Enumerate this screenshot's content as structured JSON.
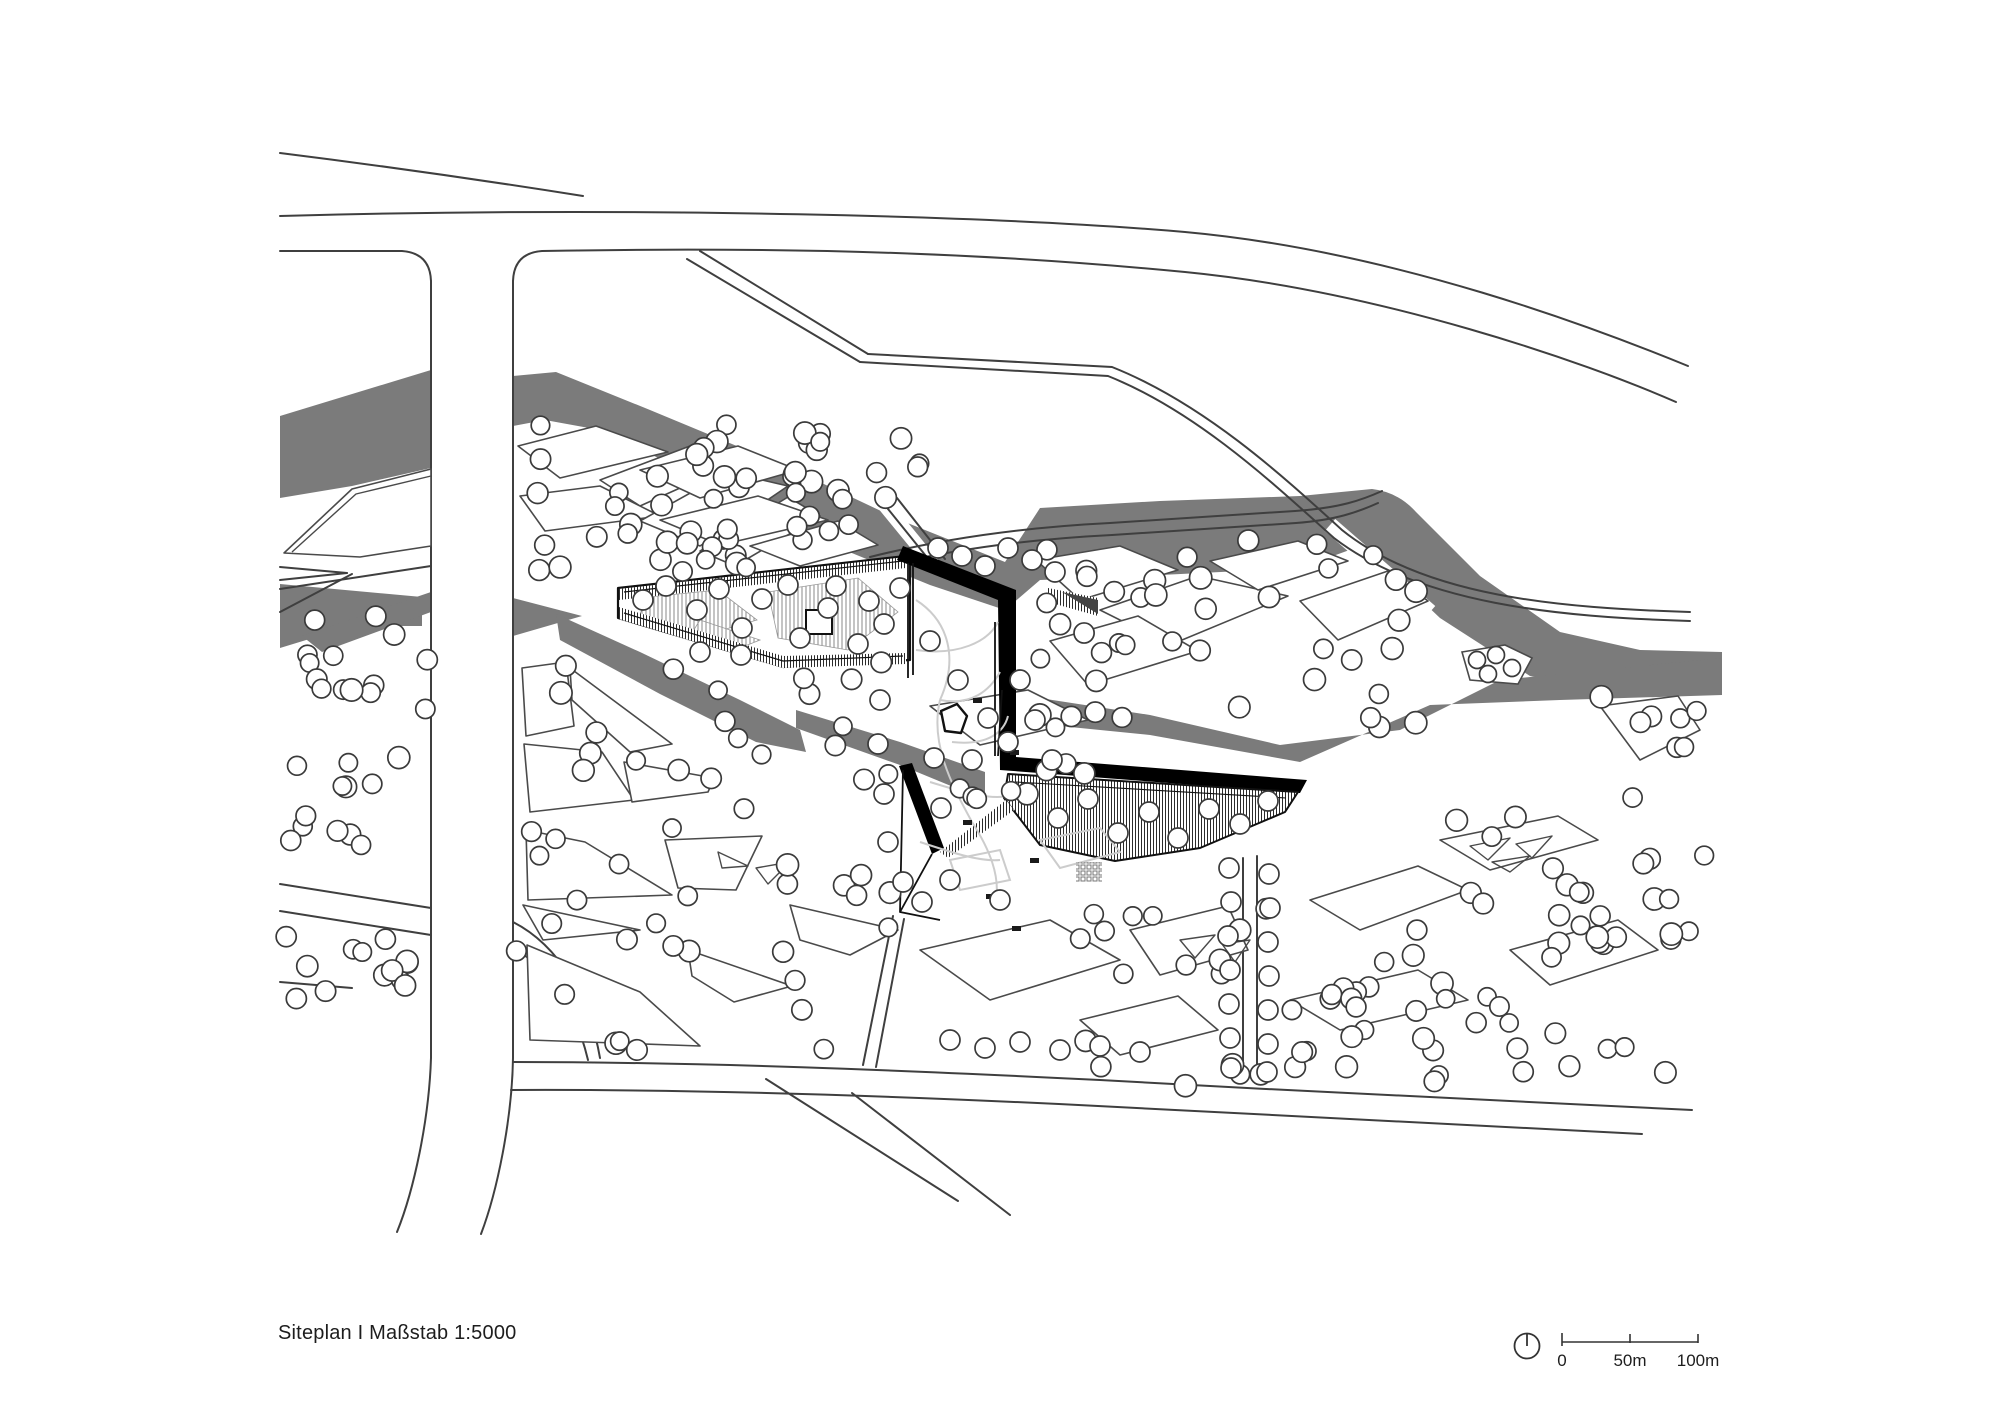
{
  "caption": {
    "text": "Siteplan I Maßstab 1:5000"
  },
  "scale_bar": {
    "labels": [
      "0",
      "50m",
      "100m"
    ],
    "north_indicator": "clock-style north circle"
  },
  "colors": {
    "river": "#7b7b7b",
    "road_line": "#3f3f3f",
    "parcel_line": "#4a4a4a",
    "building_black": "#000000",
    "tree_stroke": "#3a3a3a",
    "courtyard_path": "#cccccc",
    "background": "#ffffff",
    "text": "#1d1d1d"
  },
  "plan": {
    "rivers": [
      "M 280,416 L 431,370 L 431,468 L 352,486 L 280,498 Z",
      "M 513,376 L 556,372 L 650,410 L 790,468 L 900,520 L 1005,562 L 1005,610 L 930,585 L 820,540 L 700,478 L 600,430 L 545,420 L 513,426 Z",
      "M 1005,562 L 1040,508 L 1160,501 L 1300,496 L 1372,489 Q 1398,492 1416,512 L 1480,576 L 1560,632 L 1640,650 L 1722,652 L 1722,694 L 1620,692 L 1530,676 L 1440,618 L 1385,566 L 1355,548 L 1300,568 L 1120,577 L 1040,580 L 1005,610 Z",
      "M 280,584 L 422,597 L 422,626 L 352,626 L 280,648 Z",
      "M 302,636 L 431,592 L 431,612 L 322,652 Z",
      "M 513,598 L 582,616 L 513,636 Z",
      "M 556,614 L 640,652 L 740,700 L 800,730 L 806,752 L 756,742 L 660,694 L 560,640 Z",
      "M 796,710 L 900,742 L 985,772 L 985,800 L 900,765 L 796,728 Z",
      "M 1020,695 L 1150,715 L 1280,745 L 1400,730 L 1500,680 L 1722,658 L 1722,695 L 1560,700 L 1430,705 L 1300,762 L 1150,735 L 1020,722 Z"
    ],
    "river_gaps": [
      {
        "d": "M 882,502 L 936,568",
        "w": 14
      },
      {
        "d": "M 1330,525 L 1430,612",
        "w": 16
      }
    ],
    "roads": [
      "M 280,153 C 400,168 520,186 583,196",
      "M 280,216 C 640,206 1000,216 1185,232 C 1395,251 1600,330 1688,366",
      "M 280,251 L 402,251 Q 430,253 431,281",
      "M 513,281 Q 514,253 542,251 C 820,246 1010,255 1185,272 C 1380,291 1585,362 1676,402",
      "M 431,281 L 431,1058 C 429,1120 414,1190 397,1232",
      "M 513,281 L 513,1058 C 512,1120 497,1192 481,1234",
      "M 700,251 L 868,354",
      "M 687,259 L 860,362",
      "M 868,354 L 1112,367 C 1205,404 1285,478 1342,530 C 1425,597 1560,608 1690,612",
      "M 860,362 L 1108,376 C 1198,412 1276,486 1334,538 C 1420,604 1558,617 1690,621",
      "M 870,557 C 950,537 1030,527 1110,523 L 1295,511 C 1340,508 1362,500 1382,491",
      "M 876,568 C 952,549 1032,539 1112,535 L 1296,523 C 1336,520 1358,512 1378,503",
      "M 884,504 L 934,566",
      "M 897,498 L 945,559",
      "M 513,1062 C 700,1062 900,1070 1100,1080 C 1300,1091 1510,1102 1692,1110",
      "M 511,1090 C 700,1089 900,1096 1098,1106 C 1300,1117 1500,1127 1642,1134",
      "M 766,1079 L 958,1201",
      "M 852,1093 L 1010,1215",
      "M 893,916 L 863,1065",
      "M 904,919 L 876,1067",
      "M 1243,858 L 1243,1082",
      "M 1257,856 L 1257,1084",
      "M 280,884 L 431,908",
      "M 280,911 L 431,935",
      "M 513,922 C 560,946 590,1000 600,1058",
      "M 513,948 C 552,970 576,1010 588,1060",
      "M 280,567 L 347,573",
      "M 280,580 L 347,573",
      "M 280,589 L 431,566",
      "M 280,612 L 352,574",
      "M 280,982 L 352,988"
    ],
    "parcels": [
      "M 284,553 L 352,489 431,469 431,546 360,557 Z",
      "M 518,446 L 596,426 668,452 560,478 Z",
      "M 600,480 L 690,446 740,461 640,506 Z",
      "M 520,496 L 600,486 660,516 545,531 Z",
      "M 640,521 L 728,472 788,486 700,546 Z",
      "M 700,551 L 788,497 820,516 735,566 Z",
      "M 640,470 L 738,446 798,470 700,498 Z",
      "M 660,520 L 758,496 828,520 720,545 Z",
      "M 750,546 L 838,521 878,545 800,566 Z",
      "M 1036,560 L 1120,546 1178,570 1080,600 Z",
      "M 1100,610 L 1198,576 1288,596 1170,645 Z",
      "M 1210,561 L 1298,541 1348,561 1258,590 Z",
      "M 1300,601 L 1388,571 1428,601 1338,640 Z",
      "M 1050,641 L 1138,616 1198,651 1088,685 Z",
      "M 522,668 L 566,662 574,726 526,736 Z",
      "M 570,668 L 672,744 630,752 572,700 Z",
      "M 524,744 L 602,752 634,800 530,812 Z",
      "M 624,762 L 714,778 708,792 632,802 Z",
      "M 526,830 L 585,842 672,895 528,900 Z",
      "M 523,905 L 640,930 543,940 Z",
      "M 527,945 L 640,992 700,1046 530,1040 Z",
      "M 665,840 L 762,836 736,890 678,888 Z",
      "M 688,950 L 792,986 734,1002 692,976 Z",
      "M 790,905 L 898,930 850,955 800,940 Z",
      "M 930,706 L 1028,690 1088,720 980,745 Z",
      "M 920,950 L 1050,920 1120,960 990,1000 Z",
      "M 1130,930 L 1228,906 1248,950 1160,975 Z",
      "M 1310,900 L 1418,866 1468,890 1360,930 Z",
      "M 1440,840 L 1558,816 1598,840 1490,870 Z",
      "M 1290,1000 L 1418,970 1468,1000 1340,1030 Z",
      "M 1510,950 L 1618,920 1658,950 1550,985 Z",
      "M 1080,1020 L 1178,996 1218,1030 1120,1055 Z",
      "M 1600,706 L 1678,696 1700,730 1640,760 Z"
    ],
    "parcel_details": [
      "M 292,552 L 356,494 431,476",
      "M 718,852 L 748,866 722,868 Z",
      "M 756,868 L 790,862 768,884 Z",
      "M 1180,940 L 1215,935 1195,958 Z",
      "M 1222,944 L 1250,940 1235,962 Z",
      "M 1470,846 L 1510,838 1488,860 Z",
      "M 1516,844 L 1552,836 1532,858 Z",
      "M 1492,862 L 1530,856 1510,872 Z"
    ],
    "island": {
      "d": "M 1462,652 L 1505,645 L 1532,658 L 1518,684 L 1470,680 Z",
      "trees": [
        [
          1477,
          660
        ],
        [
          1496,
          655
        ],
        [
          1512,
          668
        ],
        [
          1488,
          674
        ]
      ]
    },
    "building": {
      "wing_upper": {
        "outline": "M 618,588 L 906,556 L 910,563 L 910,660 L 783,667 L 618,618 Z",
        "inner_lines": [
          "M 624,592 L 903,561",
          "M 624,613 L 783,661 L 903,656"
        ],
        "strips": [
          "M 619,589 L 906,557 L 906,568 L 619,600 Z",
          "M 619,607 L 783,656 L 906,653 L 906,664 L 783,668 L 619,619 Z"
        ],
        "patches": [
          "M 648,597 L 718,590 757,620 688,640 640,614 Z",
          "M 768,592 L 858,578 898,612 848,650 778,638 Z",
          "M 700,620 L 760,640 730,652 690,636 Z"
        ],
        "roof_square": {
          "x": 806,
          "y": 610,
          "w": 26,
          "h": 24
        }
      },
      "black_shapes": [
        "M 903,546 L 1016,590 L 1016,757 L 1307,780 L 1300,793 L 1000,770 L 998,600 L 897,560 Z",
        "M 899,766 L 912,763 L 944,848 L 932,854 Z"
      ],
      "wing_lower": {
        "outline": "M 1008,774 L 1298,792 L 1285,812 L 1200,848 L 1115,861 L 1040,845 L 1004,798 Z",
        "inner_lines": [
          "M 1016,782 L 1286,798"
        ],
        "strip_sw": "M 940,852 L 1006,800 L 1014,810 L 948,858 Z"
      },
      "courtyard": {
        "edges": [
          "M 908,563 L 908,678",
          "M 913,563 L 913,675",
          "M 932,854 L 900,912 L 903,770",
          "M 900,912 L 940,920",
          "M 995,622 L 995,756",
          "M 1002,690 L 998,756"
        ],
        "stair_tri": "M 1062,592 L 1098,600 L 1098,614 Z",
        "stair_ticks": "M 1048,588 L 1098,598 L 1098,616 L 1048,602 Z",
        "grid": {
          "x": 1076,
          "y": 862,
          "w": 26,
          "h": 20
        },
        "pond": "M 941,711 L 957,704 L 967,716 L 961,733 L 945,731 Z",
        "benches": [
          [
            973,
            698,
            9,
            5
          ],
          [
            1010,
            750,
            9,
            5
          ],
          [
            1020,
            788,
            9,
            5
          ],
          [
            963,
            820,
            9,
            5
          ],
          [
            986,
            894,
            9,
            5
          ],
          [
            1012,
            926,
            9,
            5
          ],
          [
            1030,
            858,
            9,
            5
          ]
        ],
        "paths_light": [
          "M 916,600 C 950,622 958,660 940,700",
          "M 940,700 C 930,742 950,782 972,822",
          "M 916,650 C 958,656 988,642 998,622",
          "M 940,700 C 972,706 990,690 1000,672",
          "M 952,742 C 988,746 1004,732 1008,716",
          "M 930,782 C 962,792 990,800 1008,796",
          "M 920,842 C 950,852 980,862 1000,860",
          "M 972,822 C 990,850 1000,876 996,900",
          "M 1040,840 L 1100,828 1120,852 1060,868 Z",
          "M 950,860 L 1000,850 1010,880 960,890 Z"
        ]
      }
    },
    "trees": {
      "radius": 10,
      "clusters": [
        {
          "x": 288,
          "y": 616,
          "w": 140,
          "h": 96,
          "n": 14,
          "seed": 1
        },
        {
          "x": 290,
          "y": 754,
          "w": 112,
          "h": 92,
          "n": 12,
          "seed": 2
        },
        {
          "x": 286,
          "y": 936,
          "w": 138,
          "h": 82,
          "n": 13,
          "seed": 3
        },
        {
          "x": 516,
          "y": 424,
          "w": 300,
          "h": 150,
          "n": 33,
          "seed": 4
        },
        {
          "x": 622,
          "y": 432,
          "w": 300,
          "h": 128,
          "n": 24,
          "seed": 5
        },
        {
          "x": 1038,
          "y": 540,
          "w": 400,
          "h": 190,
          "n": 40,
          "seed": 6
        },
        {
          "x": 1600,
          "y": 690,
          "w": 110,
          "h": 110,
          "n": 8,
          "seed": 7
        },
        {
          "x": 516,
          "y": 650,
          "w": 390,
          "h": 400,
          "n": 50,
          "seed": 8
        },
        {
          "x": 920,
          "y": 688,
          "w": 200,
          "h": 118,
          "n": 10,
          "seed": 9
        },
        {
          "x": 1080,
          "y": 900,
          "w": 360,
          "h": 190,
          "n": 30,
          "seed": 10
        },
        {
          "x": 1450,
          "y": 808,
          "w": 260,
          "h": 160,
          "n": 18,
          "seed": 11
        },
        {
          "x": 1280,
          "y": 980,
          "w": 220,
          "h": 110,
          "n": 14,
          "seed": 12
        },
        {
          "x": 1500,
          "y": 1020,
          "w": 190,
          "h": 80,
          "n": 8,
          "seed": 13
        },
        {
          "x": 1540,
          "y": 898,
          "w": 170,
          "h": 92,
          "n": 8,
          "seed": 14
        }
      ],
      "explicit": [
        [
          643,
          600
        ],
        [
          666,
          586
        ],
        [
          697,
          610
        ],
        [
          719,
          589
        ],
        [
          742,
          628
        ],
        [
          762,
          599
        ],
        [
          788,
          585
        ],
        [
          741,
          655
        ],
        [
          800,
          638
        ],
        [
          828,
          608
        ],
        [
          836,
          586
        ],
        [
          858,
          644
        ],
        [
          869,
          601
        ],
        [
          884,
          624
        ],
        [
          900,
          588
        ],
        [
          700,
          652
        ],
        [
          1058,
          818
        ],
        [
          1088,
          799
        ],
        [
          1118,
          833
        ],
        [
          1149,
          812
        ],
        [
          1178,
          838
        ],
        [
          1209,
          809
        ],
        [
          1240,
          824
        ],
        [
          1268,
          801
        ],
        [
          880,
          700
        ],
        [
          878,
          744
        ],
        [
          884,
          794
        ],
        [
          888,
          842
        ],
        [
          903,
          882
        ],
        [
          922,
          902
        ],
        [
          930,
          641
        ],
        [
          958,
          680
        ],
        [
          988,
          718
        ],
        [
          934,
          758
        ],
        [
          1008,
          742
        ],
        [
          972,
          760
        ],
        [
          941,
          808
        ],
        [
          1020,
          680
        ],
        [
          1035,
          720
        ],
        [
          1052,
          760
        ],
        [
          950,
          880
        ],
        [
          1000,
          900
        ],
        [
          1229,
          868
        ],
        [
          1269,
          874
        ],
        [
          1231,
          902
        ],
        [
          1270,
          908
        ],
        [
          1228,
          936
        ],
        [
          1268,
          942
        ],
        [
          1230,
          970
        ],
        [
          1269,
          976
        ],
        [
          1229,
          1004
        ],
        [
          1268,
          1010
        ],
        [
          1230,
          1038
        ],
        [
          1268,
          1044
        ],
        [
          1231,
          1068
        ],
        [
          1267,
          1072
        ],
        [
          938,
          548
        ],
        [
          962,
          556
        ],
        [
          985,
          566
        ],
        [
          1008,
          548
        ],
        [
          1032,
          560
        ],
        [
          1055,
          572
        ],
        [
          950,
          1040
        ],
        [
          985,
          1048
        ],
        [
          1020,
          1042
        ],
        [
          1060,
          1050
        ],
        [
          1100,
          1046
        ],
        [
          1140,
          1052
        ]
      ]
    }
  }
}
